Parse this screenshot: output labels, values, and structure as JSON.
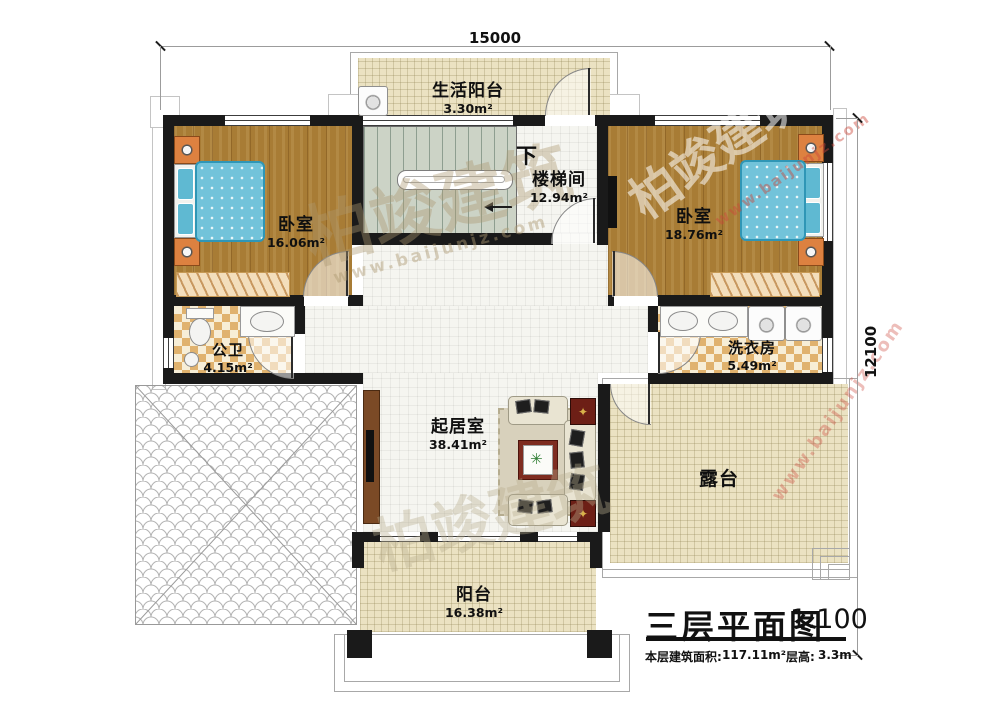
{
  "dimensions": {
    "top": "15000",
    "right": "12100"
  },
  "rooms": {
    "service_balcony": {
      "name": "生活阳台",
      "area": "3.30m²"
    },
    "bedroom_left": {
      "name": "卧室",
      "area": "16.06m²"
    },
    "stairwell": {
      "name": "楼梯间",
      "area": "12.94m²",
      "direction_label": "下"
    },
    "bedroom_right": {
      "name": "卧室",
      "area": "18.76m²"
    },
    "bathroom": {
      "name": "公卫",
      "area": "4.15m²"
    },
    "laundry": {
      "name": "洗衣房",
      "area": "5.49m²"
    },
    "living_room": {
      "name": "起居室",
      "area": "38.41m²"
    },
    "terrace": {
      "name": "露台"
    },
    "balcony": {
      "name": "阳台",
      "area": "16.38m²"
    }
  },
  "title_block": {
    "title": "三层平面图",
    "scale": "1:100",
    "floor_area_label": "本层建筑面积:",
    "floor_area_value": "117.11m²",
    "floor_height_label": "层高:",
    "floor_height_value": "3.3m"
  },
  "watermark": {
    "brand": "柏竣建筑",
    "url": "www.baijunjz.com"
  },
  "colors": {
    "wall": "#1a1a1a",
    "wood_floor": "#a87c35",
    "bed": "#72c3da",
    "checker_tile": "#e0b26e",
    "beige_floor": "#ebe2c2",
    "accent_red": "#7e2c20"
  }
}
